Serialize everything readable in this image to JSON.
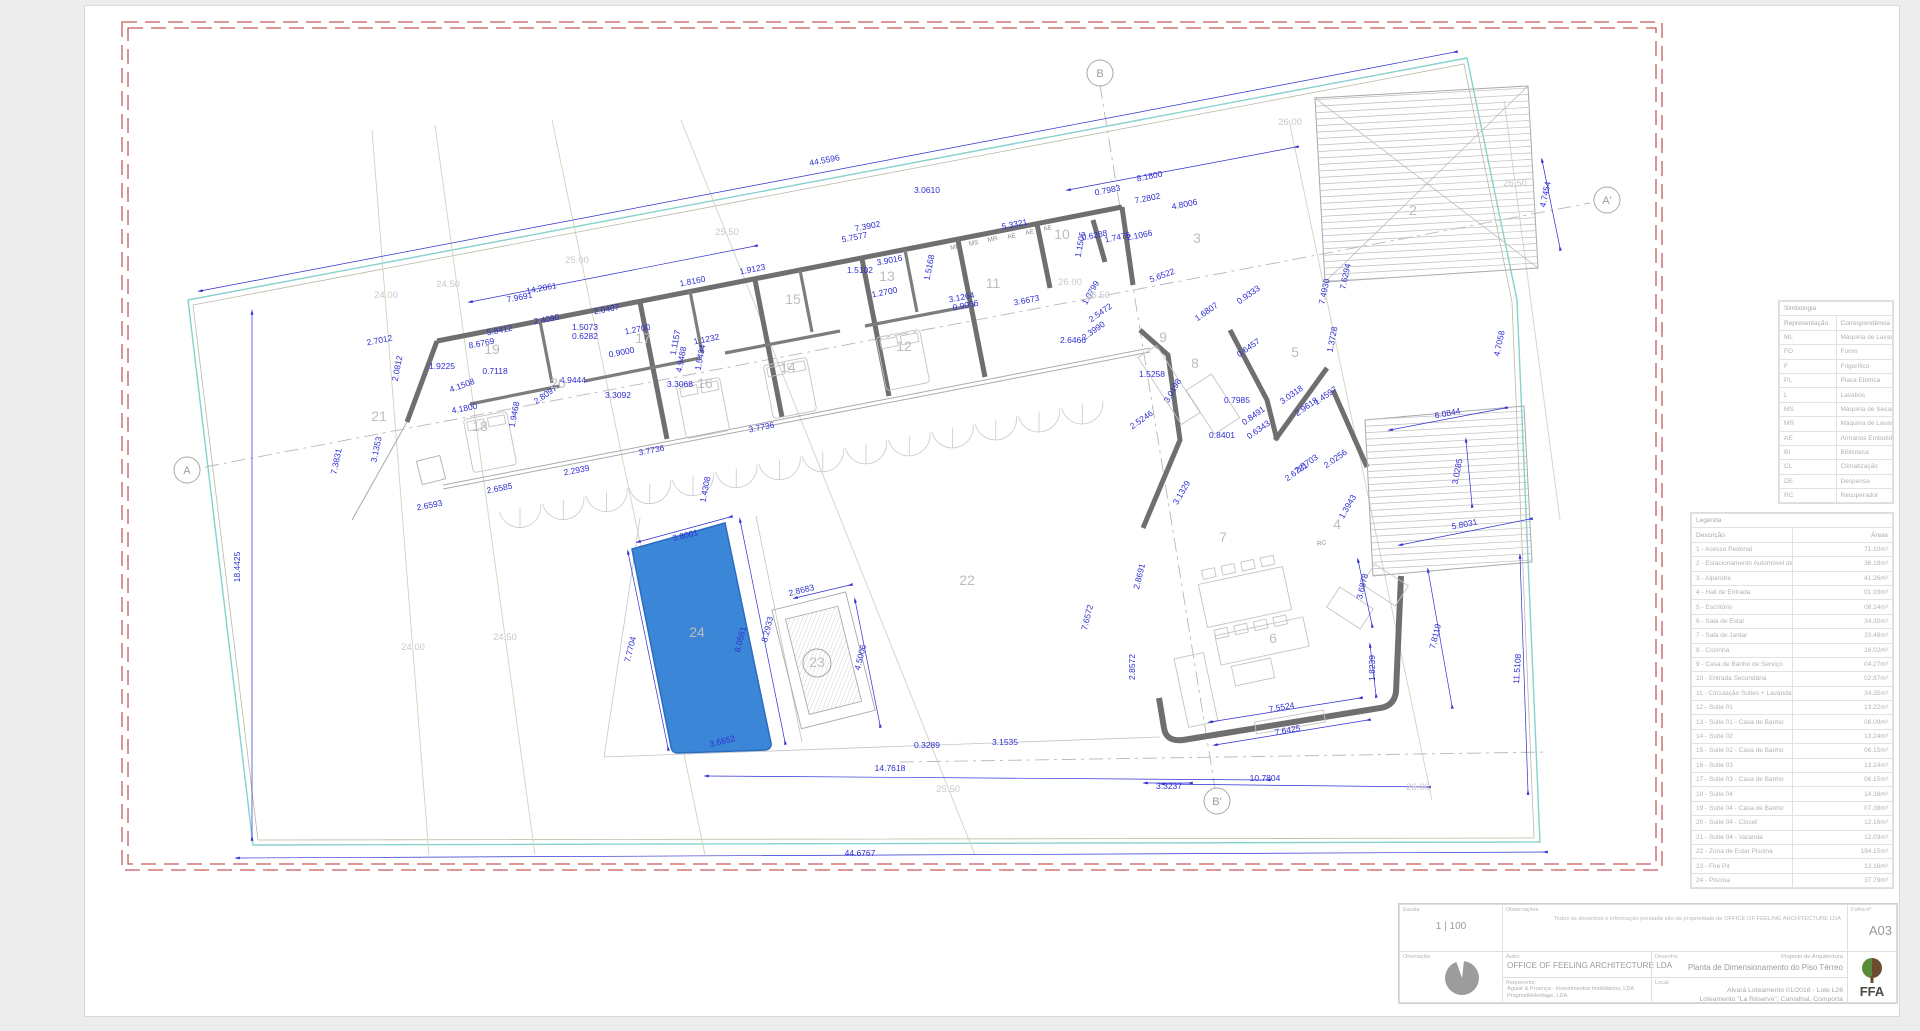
{
  "sheet": {
    "escala_label": "Escala",
    "escala_value": "1 | 100",
    "obs_label": "Observações",
    "obs_text": "Todos os desenhos e informação prestada são da propriedade de OFFICE OF FEELING ARCHITECTURE LDA",
    "folha_label": "Folha nº",
    "folha_value": "A03",
    "orient_label": "Orientação:",
    "autor_label": "Autor:",
    "autor_value": "OFFICE OF FEELING ARCHITECTURE LDA",
    "req_label": "Requerente:",
    "req_line1": "Aguiar & Proença - Investimentos Imobiliários, LDA",
    "req_line2": "PragmatikHeritage, LDA",
    "desenho_label": "Desenho:",
    "desenho_top": "Projecto de Arquitectura",
    "desenho_value": "Planta de Dimensionamento do Piso Térreo",
    "local_label": "Local:",
    "local_line1": "Alvará Loteamento 01/2018 - Lote L26",
    "local_line2": "Loteamento \"La Réserve\", Carvalhal, Comporta",
    "logo_text": "FFA"
  },
  "siglas": {
    "title": "Simbologia",
    "col_rep": "Representação",
    "col_cor": "Correspondência",
    "rows": [
      [
        "ML",
        "Máquina de Lavar"
      ],
      [
        "FO",
        "Forno"
      ],
      [
        "F",
        "Frigorífico"
      ],
      [
        "PL",
        "Placa Elétrica"
      ],
      [
        "L",
        "Lavabos"
      ],
      [
        "MS",
        "Máquina de Secar Roupa"
      ],
      [
        "MR",
        "Máquina de Lavar Roupa"
      ],
      [
        "AE",
        "Armários Embutidos"
      ],
      [
        "BI",
        "Biblioteca"
      ],
      [
        "CL",
        "Climatização"
      ],
      [
        "DE",
        "Despensa"
      ],
      [
        "RC",
        "Recuperador"
      ]
    ]
  },
  "legend": {
    "title": "Legenda",
    "col_desc": "Descrição",
    "col_area": "Áreas",
    "rows": [
      [
        "1 - Acesso Pedonal",
        "71.10m²"
      ],
      [
        "2 - Estacionamento Automóvel de 2 Viaturas",
        "36.18m²"
      ],
      [
        "3 - Alpendre",
        "41.26m²"
      ],
      [
        "4 - Hall de Entrada",
        "01.93m²"
      ],
      [
        "5 - Escritório",
        "08.14m²"
      ],
      [
        "6 - Sala de Estar",
        "34.30m²"
      ],
      [
        "7 - Sala de Jantar",
        "33.48m²"
      ],
      [
        "8 - Cozinha",
        "16.02m²"
      ],
      [
        "9 - Casa de Banho de Serviço",
        "04.27m²"
      ],
      [
        "10 - Entrada Secundária",
        "02.87m²"
      ],
      [
        "11 - Circulação Suites + Lavandaria/Zona Técnica",
        "34.35m²"
      ],
      [
        "12 - Suite 01",
        "13.22m²"
      ],
      [
        "13 - Suite 01 - Casa de Banho",
        "06.09m²"
      ],
      [
        "14 - Suite 02",
        "13.24m²"
      ],
      [
        "15 - Suite 02 - Casa de Banho",
        "06.15m²"
      ],
      [
        "16 - Suite 03",
        "13.24m²"
      ],
      [
        "17 - Suite 03 - Casa de Banho",
        "06.15m²"
      ],
      [
        "18 - Suite 04",
        "14.38m²"
      ],
      [
        "19 - Suite 04 - Casa de Banho",
        "07.38m²"
      ],
      [
        "20 - Suite 04 - Closet",
        "12.16m²"
      ],
      [
        "21 - Suite 04 - Varanda",
        "12.03m²"
      ],
      [
        "22 - Zona de Estar Piscina",
        "194.15m²"
      ],
      [
        "23 - Fire Pit",
        "13.16m²"
      ],
      [
        "24 - Piscina",
        "37.79m²"
      ]
    ]
  },
  "plan": {
    "colors": {
      "dim_blue": "#2e2ed2",
      "wall_gray": "#6f6f6f",
      "site_teal": "#86d2cd",
      "contour_olive": "#d4d2b8",
      "boundary_red": "#c65b5b",
      "pool_fill": "#3c86d8",
      "pool_stroke": "#2a6cc0",
      "light_gray": "#c4c4c4"
    },
    "dims": [
      [
        825,
        163,
        -11,
        "44.5596"
      ],
      [
        927,
        193,
        0,
        "3.0610"
      ],
      [
        1150,
        179,
        -11,
        "8.1800"
      ],
      [
        1108,
        193,
        -11,
        "0.7983"
      ],
      [
        1148,
        201,
        -11,
        "7.2802"
      ],
      [
        1185,
        207,
        -11,
        "4.8006"
      ],
      [
        868,
        229,
        -11,
        "7.3902"
      ],
      [
        855,
        240,
        -11,
        "5.7577"
      ],
      [
        1015,
        227,
        -11,
        "5.3321"
      ],
      [
        1095,
        238,
        -11,
        "0.6288"
      ],
      [
        1118,
        240,
        -11,
        "1.7476"
      ],
      [
        1140,
        238,
        -11,
        "2.1066"
      ],
      [
        1083,
        245,
        -79,
        "1.1505"
      ],
      [
        890,
        263,
        -11,
        "3.9016"
      ],
      [
        932,
        268,
        -79,
        "1.5168"
      ],
      [
        860,
        273,
        0,
        "1.5102"
      ],
      [
        885,
        295,
        -11,
        "1.2700"
      ],
      [
        962,
        300,
        -11,
        "3.1264"
      ],
      [
        966,
        308,
        -11,
        "0.9006"
      ],
      [
        1027,
        303,
        -11,
        "3.6673"
      ],
      [
        1163,
        278,
        -20,
        "5.6522"
      ],
      [
        1093,
        294,
        -60,
        "1.0799"
      ],
      [
        1102,
        315,
        -35,
        "2.5472"
      ],
      [
        1095,
        333,
        -35,
        "2.3990"
      ],
      [
        1073,
        343,
        0,
        "2.6466"
      ],
      [
        1250,
        297,
        -35,
        "0.9333"
      ],
      [
        1327,
        292,
        -78,
        "7.4930"
      ],
      [
        1348,
        277,
        -78,
        "7.6294"
      ],
      [
        1208,
        314,
        -35,
        "1.6807"
      ],
      [
        1502,
        344,
        -78,
        "4.7058"
      ],
      [
        1548,
        195,
        -78,
        "4.7454"
      ],
      [
        542,
        291,
        -11,
        "14.2061"
      ],
      [
        520,
        300,
        -11,
        "7.9691"
      ],
      [
        607,
        312,
        -11,
        "2.0407"
      ],
      [
        547,
        322,
        -11,
        "2.4090"
      ],
      [
        500,
        333,
        -11,
        "5.8412"
      ],
      [
        482,
        346,
        -11,
        "8.6769"
      ],
      [
        380,
        343,
        -11,
        "2.7012"
      ],
      [
        400,
        369,
        -79,
        "2.0812"
      ],
      [
        442,
        369,
        0,
        "1.9225"
      ],
      [
        495,
        374,
        0,
        "0.7118"
      ],
      [
        463,
        388,
        -20,
        "4.1508"
      ],
      [
        465,
        411,
        -11,
        "4.1800"
      ],
      [
        517,
        415,
        -79,
        "1.9468"
      ],
      [
        547,
        397,
        -35,
        "2.8097"
      ],
      [
        573,
        383,
        0,
        "4.9444"
      ],
      [
        618,
        398,
        0,
        "3.3092"
      ],
      [
        680,
        387,
        0,
        "3.3068"
      ],
      [
        638,
        332,
        -11,
        "1.2700"
      ],
      [
        622,
        355,
        -11,
        "0.9000"
      ],
      [
        585,
        330,
        0,
        "1.5073"
      ],
      [
        585,
        339,
        0,
        "0.6282"
      ],
      [
        678,
        343,
        -79,
        "1.1157"
      ],
      [
        684,
        360,
        -79,
        "4.9488"
      ],
      [
        703,
        358,
        -79,
        "1.5434"
      ],
      [
        707,
        342,
        -11,
        "1.1232"
      ],
      [
        753,
        272,
        -11,
        "1.9123"
      ],
      [
        693,
        284,
        -11,
        "1.8160"
      ],
      [
        379,
        450,
        -78,
        "3.1353"
      ],
      [
        339,
        462,
        -78,
        "7.3831"
      ],
      [
        430,
        508,
        -11,
        "2.6593"
      ],
      [
        500,
        491,
        -11,
        "2.6585"
      ],
      [
        577,
        473,
        -11,
        "2.2939"
      ],
      [
        652,
        453,
        -11,
        "3.7736"
      ],
      [
        762,
        430,
        -11,
        "3.7736"
      ],
      [
        708,
        490,
        -79,
        "1.4308"
      ],
      [
        240,
        567,
        -90,
        "18.4425"
      ],
      [
        686,
        538,
        -14,
        "3.8001"
      ],
      [
        633,
        650,
        -76,
        "7.7704"
      ],
      [
        743,
        640,
        -76,
        "8.0551"
      ],
      [
        770,
        630,
        -76,
        "8.2933"
      ],
      [
        802,
        593,
        -14,
        "2.8683"
      ],
      [
        863,
        658,
        -76,
        "4.5006"
      ],
      [
        723,
        744,
        -14,
        "3.6652"
      ],
      [
        890,
        771,
        0,
        "14.7618"
      ],
      [
        927,
        748,
        0,
        "0.3289"
      ],
      [
        1005,
        745,
        0,
        "3.1535"
      ],
      [
        860,
        856,
        0,
        "44.6767"
      ],
      [
        1152,
        377,
        0,
        "1.5258"
      ],
      [
        1175,
        392,
        -60,
        "3.0198"
      ],
      [
        1143,
        422,
        -35,
        "2.5246"
      ],
      [
        1184,
        494,
        -60,
        "3.1329"
      ],
      [
        1237,
        403,
        0,
        "0.7985"
      ],
      [
        1222,
        438,
        0,
        "0.8401"
      ],
      [
        1260,
        432,
        -35,
        "0.6343"
      ],
      [
        1255,
        418,
        -35,
        "0.8491"
      ],
      [
        1293,
        397,
        -35,
        "3.0318"
      ],
      [
        1308,
        409,
        -35,
        "2.9618"
      ],
      [
        1327,
        398,
        -35,
        "1.4597"
      ],
      [
        1335,
        340,
        -79,
        "1.3728"
      ],
      [
        1308,
        466,
        -35,
        "2.5703"
      ],
      [
        1298,
        474,
        -35,
        "2.6781"
      ],
      [
        1337,
        461,
        -35,
        "2.0256"
      ],
      [
        1350,
        508,
        -60,
        "1.3943"
      ],
      [
        1448,
        416,
        -11,
        "6.0844"
      ],
      [
        1460,
        472,
        -79,
        "3.0285"
      ],
      [
        1465,
        527,
        -11,
        "5.8031"
      ],
      [
        1250,
        350,
        -35,
        "0.6457"
      ],
      [
        1142,
        577,
        -76,
        "2.8691"
      ],
      [
        1135,
        667,
        -90,
        "2.8572"
      ],
      [
        1365,
        587,
        -76,
        "3.6878"
      ],
      [
        1438,
        637,
        -76,
        "7.8119"
      ],
      [
        1375,
        668,
        -90,
        "1.8239"
      ],
      [
        1282,
        710,
        -10,
        "7.5524"
      ],
      [
        1288,
        733,
        -10,
        "7.6425"
      ],
      [
        1265,
        781,
        0,
        "10.7804"
      ],
      [
        1169,
        789,
        0,
        "3.3237"
      ],
      [
        1520,
        669,
        -86,
        "11.5108"
      ],
      [
        1090,
        618,
        -76,
        "7.6572"
      ]
    ],
    "gray_labels": [
      [
        386,
        298,
        "24.00"
      ],
      [
        448,
        287,
        "24.50"
      ],
      [
        577,
        263,
        "25.00"
      ],
      [
        727,
        235,
        "25.50"
      ],
      [
        1070,
        285,
        "26.00"
      ],
      [
        1098,
        298,
        "26.50"
      ],
      [
        413,
        650,
        "24.00"
      ],
      [
        505,
        640,
        "24.50"
      ],
      [
        948,
        792,
        "25.50"
      ],
      [
        1418,
        790,
        "26.00"
      ],
      [
        1290,
        125,
        "26.00"
      ],
      [
        1515,
        186,
        "26.50"
      ]
    ],
    "rooms": [
      [
        379,
        421,
        "21"
      ],
      [
        480,
        431,
        "18"
      ],
      [
        558,
        388,
        "20"
      ],
      [
        492,
        354,
        "19"
      ],
      [
        643,
        343,
        "17"
      ],
      [
        705,
        388,
        "16"
      ],
      [
        793,
        304,
        "15"
      ],
      [
        788,
        372,
        "14"
      ],
      [
        887,
        281,
        "13"
      ],
      [
        904,
        351,
        "12"
      ],
      [
        993,
        288,
        "11"
      ],
      [
        1062,
        239,
        "10"
      ],
      [
        1163,
        342,
        "9"
      ],
      [
        1197,
        243,
        "3"
      ],
      [
        1413,
        215,
        "2"
      ],
      [
        1295,
        357,
        "5"
      ],
      [
        1195,
        368,
        "8"
      ],
      [
        1223,
        542,
        "7"
      ],
      [
        1337,
        529,
        "4"
      ],
      [
        1273,
        643,
        "6"
      ],
      [
        967,
        585,
        "22"
      ],
      [
        697,
        637,
        "24"
      ]
    ],
    "circled_room": {
      "x": 817,
      "y": 663,
      "t": "23"
    },
    "markers": [
      {
        "x": 187,
        "y": 470,
        "t": "A"
      },
      {
        "x": 1607,
        "y": 200,
        "t": "A'"
      },
      {
        "x": 1100,
        "y": 73,
        "t": "B"
      },
      {
        "x": 1217,
        "y": 801,
        "t": "B'"
      }
    ],
    "closet_tags": [
      [
        955,
        249,
        "ML"
      ],
      [
        974,
        245,
        "MS"
      ],
      [
        993,
        241,
        "MR"
      ],
      [
        1012,
        238,
        "AE"
      ],
      [
        1030,
        234,
        "AE"
      ],
      [
        1048,
        230,
        "AE"
      ],
      [
        1322,
        545,
        "RC"
      ]
    ]
  }
}
